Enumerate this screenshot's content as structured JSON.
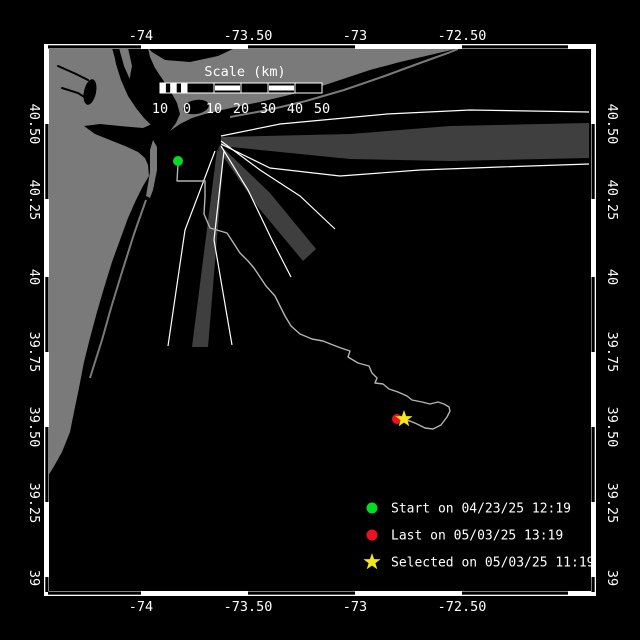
{
  "colors": {
    "background": "#000000",
    "land": "#7a7a7a",
    "beam": "#3f3f3f",
    "track": "#b3b3b3",
    "frame": "#ffffff",
    "start_marker": "#00dd22",
    "last_marker": "#ee1122",
    "selected_marker": "#f2e818"
  },
  "axes": {
    "top": {
      "labels": [
        "-74",
        "-73.50",
        "-73",
        "-72.50"
      ],
      "x": [
        141,
        248,
        355,
        462
      ],
      "baseline_y": 40
    },
    "bottom": {
      "labels": [
        "-74",
        "-73.50",
        "-73",
        "-72.50"
      ],
      "x": [
        141,
        248,
        355,
        462
      ],
      "baseline_y": 611
    },
    "left": {
      "labels": [
        "40.50",
        "40.25",
        "40",
        "39.75",
        "39.50",
        "39.25",
        "39"
      ],
      "y": [
        124,
        200,
        277,
        352,
        427,
        503,
        578
      ],
      "anchor_x": 30
    },
    "right": {
      "labels": [
        "40.50",
        "40.25",
        "40",
        "39.75",
        "39.50",
        "39.25",
        "39"
      ],
      "y": [
        124,
        200,
        277,
        352,
        427,
        503,
        578
      ],
      "anchor_x": 608
    }
  },
  "frame": {
    "outer": [
      44,
      44,
      596,
      596
    ],
    "zebra_horizontal": [
      [
        48,
        141
      ],
      [
        248,
        355
      ],
      [
        462,
        568
      ]
    ],
    "zebra_vertical": [
      [
        124,
        199
      ],
      [
        277,
        352
      ],
      [
        427,
        502
      ],
      [
        577,
        592
      ]
    ]
  },
  "scalebar": {
    "title": "Scale (km)",
    "title_x": 245,
    "title_y": 76,
    "bar_x": 160,
    "bar_y": 83,
    "bar_h": 10,
    "zero_x": 187,
    "seg_w": 27,
    "small_cells": 5,
    "filled_segments": [
      1,
      3
    ],
    "labels": [
      "10",
      "0",
      "10",
      "20",
      "30",
      "40",
      "50"
    ],
    "label_x": [
      160,
      187,
      214,
      241,
      268,
      295,
      322
    ],
    "label_y": 113
  },
  "legend": {
    "marker_x": 372,
    "text_x": 391,
    "rows_y": [
      508,
      535,
      562
    ],
    "items": [
      {
        "marker": "circle",
        "color": "#00dd22",
        "label": "Start on 04/23/25 12:19"
      },
      {
        "marker": "circle",
        "color": "#ee1122",
        "label": "Last on 05/03/25 13:19"
      },
      {
        "marker": "star",
        "color": "#f2e818",
        "label": "Selected on 05/03/25 11:19"
      }
    ]
  },
  "markers": {
    "start": {
      "shape": "circle",
      "x": 178,
      "y": 161,
      "r": 5,
      "color": "#00dd22"
    },
    "last": {
      "shape": "circle",
      "x": 397,
      "y": 419,
      "r": 5,
      "color": "#ee1122"
    },
    "selected": {
      "shape": "star",
      "x": 404,
      "y": 419,
      "R": 9,
      "r": 3.6,
      "color": "#f2e818"
    }
  },
  "geometry": {
    "land": [
      {
        "name": "land-new-jersey",
        "points": "48,48 112,48 116,62 122,78 130,90 140,100 148,108 153,116 152,124 143,128 120,126 100,124 84,126 95,134 110,140 125,146 138,152 145,158 148,165 149,176 143,186 136,200 128,218 120,240 112,262 104,288 97,312 90,338 84,362 79,388 74,412 70,432 62,452 53,468 48,476"
      },
      {
        "name": "land-sandy-hook",
        "points": "146,196 150,172 150,150 153,140 157,147 157,170 153,190 150,198"
      },
      {
        "name": "land-manhattan",
        "points": "119,48 128,48 132,66 129,82 124,72 120,58"
      },
      {
        "name": "land-long-island",
        "points": "137,48 460,48 430,55 400,62 370,70 340,80 310,90 285,96 260,102 240,106 222,110 205,114 192,118 180,124 170,131 176,123 180,114 177,103 171,92 163,80 155,68 150,57 148,48"
      }
    ],
    "water": [
      {
        "name": "water-hudson-harbor",
        "kind": "polygon",
        "points": "113,48 119,48 124,66 131,82 140,93 149,102 156,111 158,120 152,126 144,118 136,108 128,96 121,80 116,64"
      },
      {
        "name": "water-li-sound",
        "kind": "polygon",
        "points": "148,48 235,48 218,56 190,62 165,60 152,52"
      },
      {
        "name": "water-jamaica-bay",
        "kind": "ellipse",
        "cx": 196,
        "cy": 107,
        "rx": 13,
        "ry": 7,
        "rot": -10
      },
      {
        "name": "water-newark-bay",
        "kind": "ellipse",
        "cx": 90,
        "cy": 92,
        "rx": 6,
        "ry": 13,
        "rot": 12
      },
      {
        "name": "water-bay-1",
        "kind": "ellipse",
        "cx": 272,
        "cy": 104,
        "rx": 26,
        "ry": 4,
        "rot": -9
      },
      {
        "name": "water-bay-2",
        "kind": "ellipse",
        "cx": 340,
        "cy": 86,
        "rx": 28,
        "ry": 4.5,
        "rot": -16
      },
      {
        "name": "water-bay-3",
        "kind": "ellipse",
        "cx": 410,
        "cy": 66,
        "rx": 24,
        "ry": 4,
        "rot": -19
      },
      {
        "name": "water-barnegat-bay",
        "kind": "stroke",
        "w": 5,
        "points": "141,206 130,236 119,266 109,298 100,328 93,352"
      },
      {
        "name": "water-creek-1",
        "kind": "stroke",
        "w": 2,
        "points": "58,66 76,74 88,80"
      },
      {
        "name": "water-creek-2",
        "kind": "stroke",
        "w": 2,
        "points": "62,88 78,93 86,98"
      }
    ],
    "barriers": [
      {
        "name": "barrier-island-nj",
        "points": "146,200 134,234 122,272 111,308 102,340 95,362 90,378"
      },
      {
        "name": "barrier-island-li",
        "points": "230,117 268,110 306,101 344,90 382,77 420,63 448,53 458,49"
      }
    ],
    "beams": [
      {
        "name": "radar-beam-east",
        "points": "221,137 350,134 450,126 589,123 589,158 450,161 350,159 221,146"
      },
      {
        "name": "radar-beam-southeast",
        "points": "220,145 270,193 316,249 303,261 258,207 218,149"
      },
      {
        "name": "radar-beam-south",
        "points": "217,150 224,153 208,347 192,347"
      }
    ],
    "rays": [
      {
        "name": "radar-ray-1",
        "points": "221,136 280,124 387,114 470,110 589,112"
      },
      {
        "name": "radar-ray-2",
        "points": "221,144 270,168 340,176 420,170 500,167 589,164"
      },
      {
        "name": "radar-ray-3",
        "points": "221,141 260,170 300,196 335,229"
      },
      {
        "name": "radar-ray-4",
        "points": "221,146 248,190 272,240 291,277"
      },
      {
        "name": "radar-ray-5",
        "points": "215,151 185,230 168,346"
      },
      {
        "name": "radar-ray-6",
        "points": "224,151 214,240 232,345"
      }
    ],
    "track": {
      "name": "drifter-track",
      "points": "178,164 177,181 205,181 205,197 204,214 210,228 227,233 240,253 248,261 254,268 260,277 266,286 275,296 280,306 285,316 291,326 300,334 312,339 323,341 333,345 341,348 350,351 348,357 358,363 369,366 372,373 377,378 375,383 383,384 389,389 398,392 407,396 412,400 422,402 430,404 438,402 444,404 449,407 450,411 447,417 441,425 433,429 425,428 417,424 410,421 397,419"
    }
  }
}
